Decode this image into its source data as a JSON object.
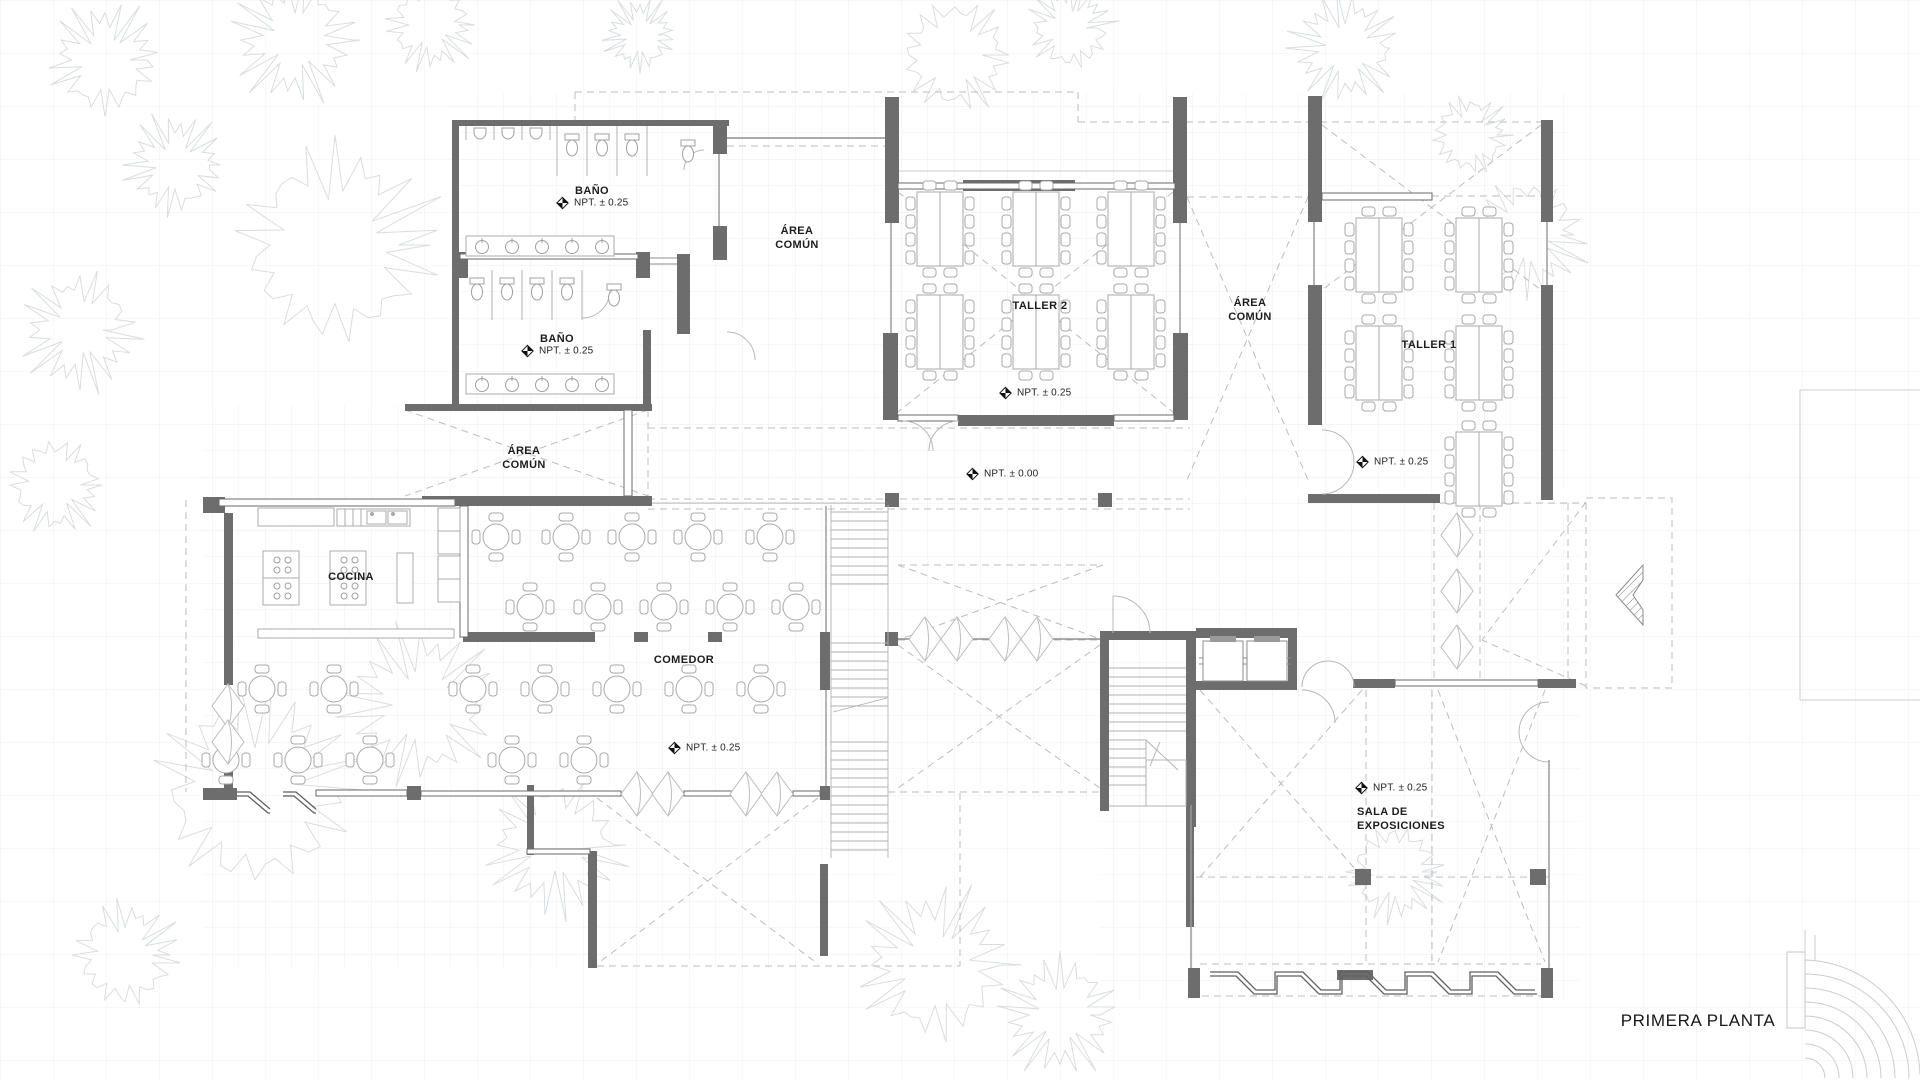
{
  "plan": {
    "title": "PRIMERA PLANTA",
    "rooms": {
      "bano1": {
        "label": "BAÑO",
        "level": "NPT. ± 0.25"
      },
      "bano2": {
        "label": "BAÑO",
        "level": "NPT. ± 0.25"
      },
      "area_comun_1": {
        "line1": "ÁREA",
        "line2": "COMÚN"
      },
      "area_comun_2": {
        "line1": "ÁREA",
        "line2": "COMÚN"
      },
      "area_comun_3": {
        "line1": "ÁREA",
        "line2": "COMÚN"
      },
      "taller2": {
        "label": "TALLER 2",
        "level": "NPT. ± 0.25"
      },
      "taller1": {
        "label": "TALLER 1",
        "level": "NPT. ± 0.25"
      },
      "cocina": {
        "label": "COCINA"
      },
      "comedor": {
        "label": "COMEDOR",
        "level": "NPT. ± 0.25"
      },
      "patio": {
        "level": "NPT. ± 0.00"
      },
      "sala": {
        "line1": "SALA DE",
        "line2": "EXPOSICIONES",
        "level": "NPT. ± 0.25"
      }
    }
  }
}
